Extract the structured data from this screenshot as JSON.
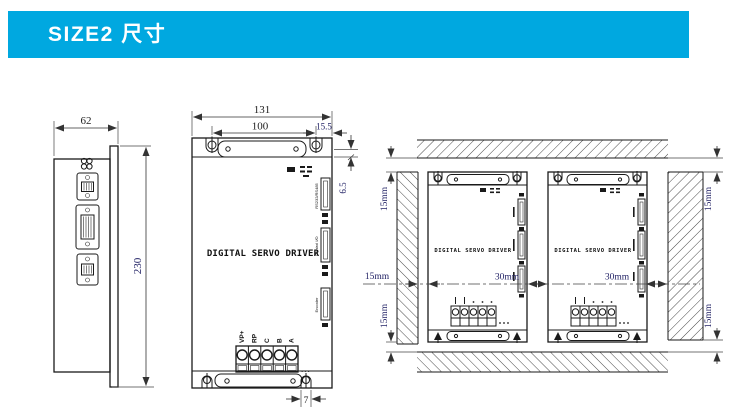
{
  "header": {
    "title": "SIZE2 尺寸",
    "accent_color": "#00A8E0"
  },
  "side_view": {
    "width": "62",
    "height": "230"
  },
  "front_view": {
    "label": "DIGITAL SERVO DRIVER",
    "dims": {
      "overall_width": "131",
      "hole_span": "100",
      "edge_offset": "15.5",
      "top_offset": "6.5",
      "slot_width": "7"
    },
    "terminals": [
      "VP+",
      "RP",
      "C",
      "B",
      "A"
    ],
    "ports": [
      "RS232/RS485",
      "Control I/O",
      "Encoder"
    ],
    "ellipsis": "..."
  },
  "install_view": {
    "unit_label": "DIGITAL SERVO DRIVER",
    "dims": {
      "top_left": "15mm",
      "left": "15mm",
      "bottom_left": "15mm",
      "gap_units": "30mm",
      "gap_wall": "30mm",
      "top_right": "15mm",
      "bottom_right": "15mm"
    }
  },
  "colors": {
    "line": "#1a1a1a",
    "dim_text_blue": "#232366",
    "dim_text_black": "#1d1d1d"
  }
}
